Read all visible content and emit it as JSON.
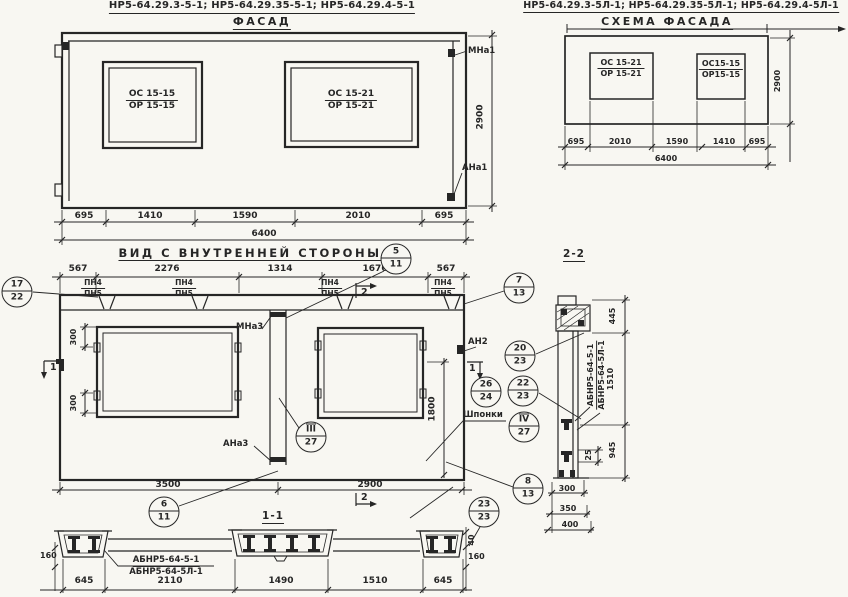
{
  "ink": "#262626",
  "paper": "#f8f7f2",
  "facade": {
    "codes": "НР5-64.29.3-5-1; НР5-64.29.35-5-1; НР5-64.29.4-5-1",
    "title": "ФАСАД",
    "window_left": {
      "top": "ОС 15-15",
      "bottom": "ОР 15-15"
    },
    "window_right": {
      "top": "ОС 15-21",
      "bottom": "ОР 15-21"
    },
    "anchor_top_right": "МНа1",
    "anchor_bottom_right": "АНа1",
    "height": "2900",
    "dims": [
      "695",
      "1410",
      "1590",
      "2010",
      "695"
    ],
    "total": "6400"
  },
  "schema": {
    "codes": "НР5-64.29.3-5Л-1; НР5-64.29.35-5Л-1; НР5-64.29.4-5Л-1",
    "title": "СХЕМА ФАСАДА",
    "window_left": {
      "top": "ОС 15-21",
      "bottom": "ОР 15-21"
    },
    "window_right": {
      "top": "ОС15-15",
      "bottom": "ОР15-15"
    },
    "height": "2900",
    "dims": [
      "695",
      "2010",
      "1590",
      "1410",
      "695"
    ],
    "total": "6400"
  },
  "view": {
    "title": "ВИД С ВНУТРЕННЕЙ СТОРОНЫ",
    "top_dims": [
      "567",
      "2276",
      "1314",
      "1676",
      "567"
    ],
    "joint_labels": {
      "top": "ПН4",
      "bottom": "ПН5"
    },
    "anchor_mid_top": "МНа3",
    "anchor_mid_bottom": "АНа3",
    "anchor_right": "АН2",
    "keys_label": "Шпонки",
    "dim_300_upper": "300",
    "dim_300_lower": "300",
    "dim_1800": "1800",
    "bottom_dims": [
      "3500",
      "2900"
    ],
    "marker_1": "1",
    "marker_2": "2",
    "section_title": "1-1"
  },
  "callouts": {
    "c5_11": {
      "top": "5",
      "bottom": "11"
    },
    "c17_22": {
      "top": "17",
      "bottom": "22"
    },
    "c7_13": {
      "top": "7",
      "bottom": "13"
    },
    "c20_23": {
      "top": "20",
      "bottom": "23"
    },
    "c26_24": {
      "top": "26",
      "bottom": "24"
    },
    "c22_23": {
      "top": "22",
      "bottom": "23"
    },
    "c3_27": {
      "top": "III",
      "bottom": "27"
    },
    "c4_27": {
      "top": "IV",
      "bottom": "27"
    },
    "c6_11": {
      "top": "6",
      "bottom": "11"
    },
    "c8_13": {
      "top": "8",
      "bottom": "13"
    },
    "c23_23": {
      "top": "23",
      "bottom": "23"
    }
  },
  "section2": {
    "title": "2-2",
    "code_1": "АБНР5-64-5-1",
    "code_2": "АБНР5-64-5Л-1",
    "d445": "445",
    "d1510": "1510",
    "d945": "945",
    "d25": "25",
    "d300": "300",
    "d350": "350",
    "d400": "400"
  },
  "section1": {
    "code_1": "АБНР5-64-5-1",
    "code_2": "АБНР5-64-5Л-1",
    "dims": [
      "645",
      "2110",
      "1490",
      "1510",
      "645"
    ],
    "d160_left": "160",
    "d160_right": "160",
    "d40": "40"
  }
}
